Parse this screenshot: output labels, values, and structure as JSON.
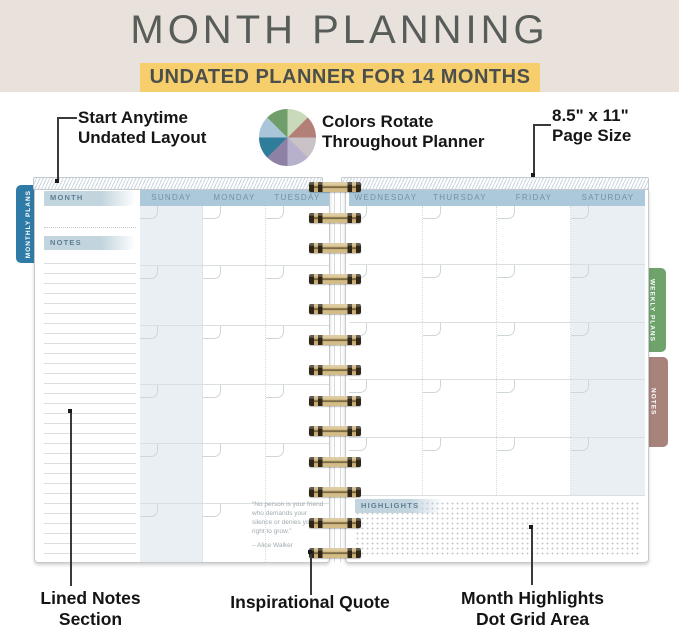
{
  "header": {
    "title": "MONTH PLANNING",
    "subtitle": "UNDATED PLANNER FOR 14 MONTHS",
    "colors": {
      "band_bg": "#E9E2DC",
      "subtitle_bg": "#F6CE6B",
      "title_text": "#585D59",
      "subtitle_text": "#4B4F4C"
    }
  },
  "feature_callouts": {
    "start_anytime": {
      "line1": "Start Anytime",
      "line2": "Undated Layout"
    },
    "colors_rotate": {
      "line1": "Colors Rotate",
      "line2": "Throughout Planner"
    },
    "page_size": {
      "line1": "8.5\" x 11\"",
      "line2": "Page Size"
    }
  },
  "color_wheel": {
    "segments": [
      "#C9DABB",
      "#B28076",
      "#C9C2C6",
      "#B7B1CD",
      "#8D81A6",
      "#2F7D9B",
      "#A9C6D8",
      "#6F9E6A"
    ]
  },
  "bottom_callouts": {
    "lined_notes": {
      "line1": "Lined Notes",
      "line2": "Section"
    },
    "inspirational_quote": {
      "line1": "Inspirational Quote"
    },
    "month_highlights": {
      "line1": "Month Highlights",
      "line2": "Dot Grid Area"
    }
  },
  "planner": {
    "side_tabs": {
      "monthly": {
        "label": "MONTHLY PLANS",
        "color": "#2F7BA7"
      },
      "weekly": {
        "label": "WEEKLY PLANS",
        "color": "#6FA36C"
      },
      "notes": {
        "label": "NOTES",
        "color": "#A8837B"
      }
    },
    "left_page": {
      "month_tab": "MONTH",
      "notes_tab": "NOTES",
      "day_headers": [
        "SUNDAY",
        "MONDAY",
        "TUESDAY"
      ],
      "week_rows": 6,
      "quote": {
        "lines": [
          "\"No person is your friend",
          "who demands your",
          "silence or denies your",
          "right to grow.\""
        ],
        "author": "– Alice Walker"
      }
    },
    "right_page": {
      "day_headers": [
        "WEDNESDAY",
        "THURSDAY",
        "FRIDAY",
        "SATURDAY"
      ],
      "week_rows": 5,
      "highlights_tab": "HIGHLIGHTS"
    },
    "colors": {
      "day_band": "#ABC9DB",
      "day_text": "#76909F",
      "weekend_shade": "#E9EFF3",
      "mini_tab_fill": "#C2D4DE",
      "mini_tab_text": "#5E7F96",
      "spiral_gold": "#D3BC85",
      "spiral_dark": "#2E2517"
    }
  }
}
